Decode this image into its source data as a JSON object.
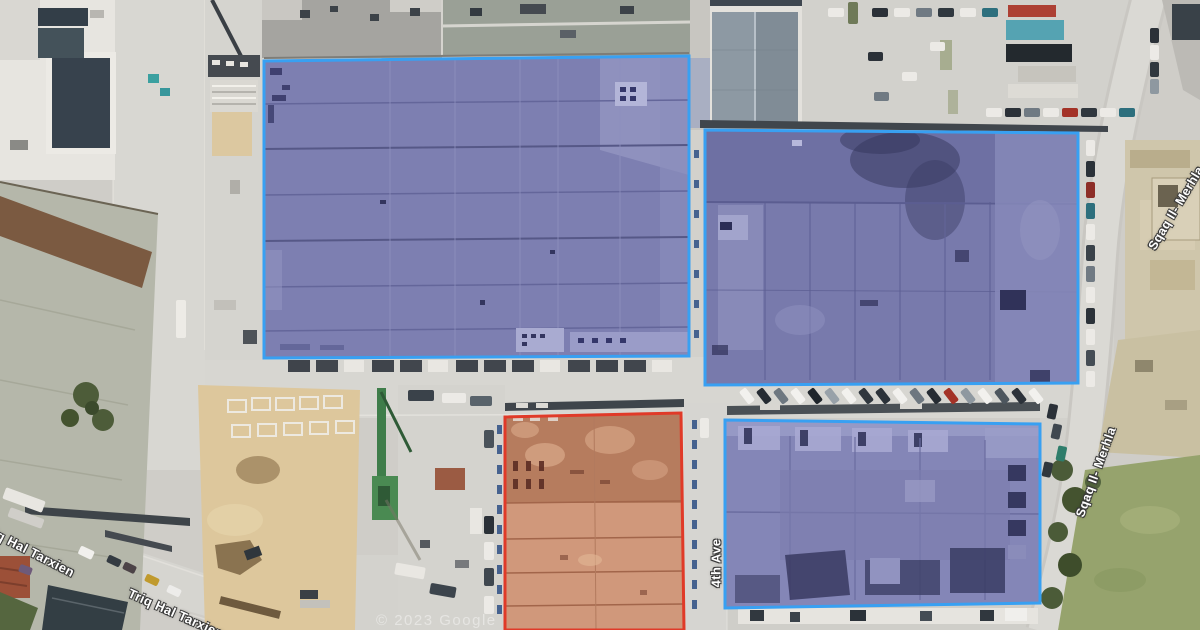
{
  "map": {
    "view_type": "satellite",
    "attribution": "© 2023 Google",
    "street_labels": [
      {
        "id": "triq-hal-tarxien-1",
        "text": "Triq Hal Tarxien"
      },
      {
        "id": "triq-hal-tarxien-2",
        "text": "Triq Hal Tarxien"
      },
      {
        "id": "fourth-ave",
        "text": "4th Ave"
      },
      {
        "id": "sqaq-il-merhla-1",
        "text": "Sqaq Il- Merhla"
      },
      {
        "id": "sqaq-il-merhla-2",
        "text": "Sqaq Il- Merhla"
      }
    ],
    "highlighted_parcels": [
      {
        "id": "warehouse-northwest",
        "outline_color": "#38a0f2",
        "fill_color": "#7d7fb1"
      },
      {
        "id": "warehouse-northeast",
        "outline_color": "#38a0f2",
        "fill_color": "#787aac"
      },
      {
        "id": "warehouse-southeast",
        "outline_color": "#38a0f2",
        "fill_color": "#8486b7"
      },
      {
        "id": "warehouse-south-central",
        "outline_color": "#e03a28",
        "fill_color": "#c98f72"
      }
    ]
  }
}
